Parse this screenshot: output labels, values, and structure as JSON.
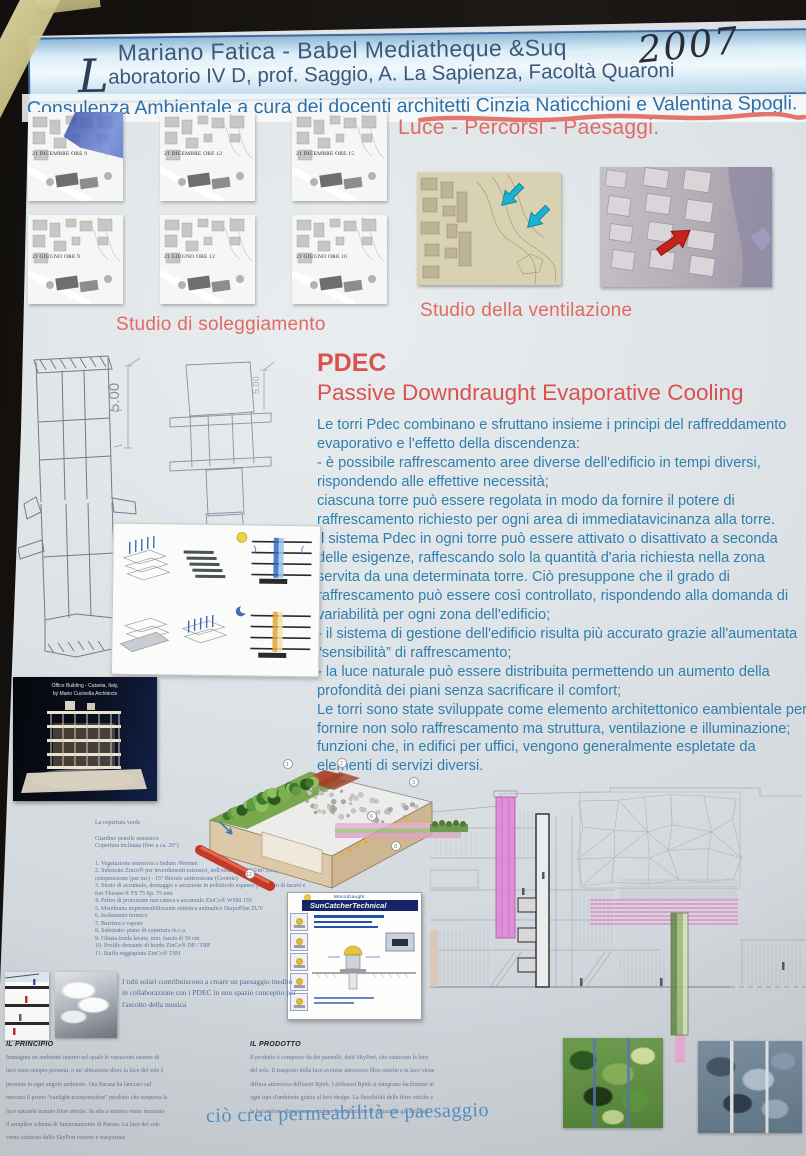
{
  "header": {
    "line1": "Mariano Fatica - Babel Mediatheque &Suq",
    "line2_initial": "L",
    "line2_rest": "aboratorio IV D, prof. Saggio, A. La Sapienza, Facoltà Quaroni",
    "year_handwritten": "2007",
    "line3_plain": "Consulenza Ambientale a cura dei docenti ",
    "line3_underlined": "architetti Cinzia Naticchioni e Valentina Spogli."
  },
  "sun_study": {
    "caption": "Studio di soleggiamento",
    "thumbnails": [
      {
        "label": "21 DICEMBRE ORE 9"
      },
      {
        "label": "21 DICEMBRE ORE 12"
      },
      {
        "label": "21 DICEMBRE ORE 15"
      },
      {
        "label": "21 GIUGNO ORE 9"
      },
      {
        "label": "21 GIUGNO ORE 12"
      },
      {
        "label": "21 GIUGNO ORE 16"
      }
    ]
  },
  "light_section": {
    "title": "Luce - Percorsi - Paesaggi.",
    "ventilation_caption": "Studio della ventilazione"
  },
  "pdec": {
    "title": "PDEC",
    "subtitle": "Passive Downdraught Evaporative Cooling",
    "paragraphs": [
      "Le torri Pdec combinano e sfruttano insieme i principi del raffreddamento evaporativo e l'effetto della discendenza:",
      "- è possibile raffrescamento aree diverse dell'edificio in tempi diversi, rispondendo alle effettive necessità;",
      "ciascuna torre può essere regolata in modo da fornire il potere di raffrescamento richiesto per ogni area di immediatavicinanza alla torre.",
      "Il sistema Pdec in ogni torre può essere attivato o disattivato a seconda delle esigenze, raffescando solo la quantità d'aria richiesta nella zona servita da una determinata torre. Ciò presuppone che il grado di raffrescamento può essere così controllato, rispondendo alla domanda di variabilità per ogni zona dell'edificio;",
      "- il sistema di gestione dell'edificio risulta più accurato grazie all'aumentata “sensibilità” di raffrescamento;",
      "- la luce naturale può essere distribuita permettendo un aumento della profondità dei piani senza sacrificare il comfort;",
      "Le torri sono state sviluppate come elemento architettonico eambientale per fornire non solo raffrescamento ma struttura, ventilazione e illuminazione; funzioni che, in edifici per uffici, vengono generalmente espletate da elementi di servizi diversi."
    ]
  },
  "tower_drawing": {
    "dimension_label": "5.00"
  },
  "office_photo": {
    "caption_line1": "Office Building - Catania, Italy,",
    "caption_line2": "by Mario Cucinella Architects"
  },
  "green_roof": {
    "title": "La copertura verde",
    "subtitle1": "Giardino pensile estensivo",
    "subtitle2": "Copertura inclinata (fino a ca. 20°)",
    "items": [
      "1. Vegetazione estensiva a Sedum /Perenni",
      "2. Substrato Zinco® per inverdimenti estensivi, nell'ordine di 100 l/m² compreso coeff. di compressione (per mc) - 15° Biorete antierosione (Georete)",
      "3. Strato di accumulo, drenaggio e aerazione in polistirolo espanso provvisto di incavi e fori Floratec® FS 75 Sp. 75 mm",
      "4. Feltro di protezione meccanica e accumulo ZinCo® WSM 150",
      "5. Membrana impermeabilizzante sintetica antiradice HarpoPlan ZUV",
      "6. Isolamento termico",
      "7. Barriera a vapore",
      "8. Substrato: piano di copertura in c.a.",
      "9. Ghiaia tonda lavata, min. fascia di 50 cm",
      "10. Profilo drenante di bordo ZinCo® DP / TRP",
      "11. Staffa reggispinta ZinCo® TSH"
    ]
  },
  "suncatcher": {
    "brand": "Monodraught",
    "title": "SunCatcherTechnical"
  },
  "solar_tubes_note": "I tubi solari contribuiscono a creare un paesaggio inedito in collaborazione con i PDEC in uno spazio concepito per l'ascolto della musica",
  "principle": {
    "heading": "IL PRINCIPIO",
    "text": "Immagina un ambiente interno nel quale le variazioni esterne di luce sono sempre presenti, o un' abitazione dove la luce del sole è presente in ogni angolo ambiente. Ora Parans ha lanciato sul mercato il primo “sunlight-transportation” prodotto che trasporta la luce naturale tramite fibre ottiche. In alto a sinistra viene mostrato il semplice schema di funzionamento di Parans. La luce del sole viene catturata dallo SkyPort esterno e trasportata"
  },
  "product": {
    "heading": "IL PRODOTTO",
    "text": "Il prodotto è composto da dei pannelli, detti SkyPort, che catturano la luce del sole. Il trasporto della luce avviene attraverso fibre ottiche e la luce viene diffusa attraverso diffusori Björk. I diffusori Björk si integrano facilmente in ogni tipo d'ambiente grazie al loro design. La flessibilità delle fibre ottiche e la loro ridotta dimensione rendono l'installazione in abitazioni già esistenti",
    "overlay_text": "ciò crea permeabilità e paesaggio"
  }
}
